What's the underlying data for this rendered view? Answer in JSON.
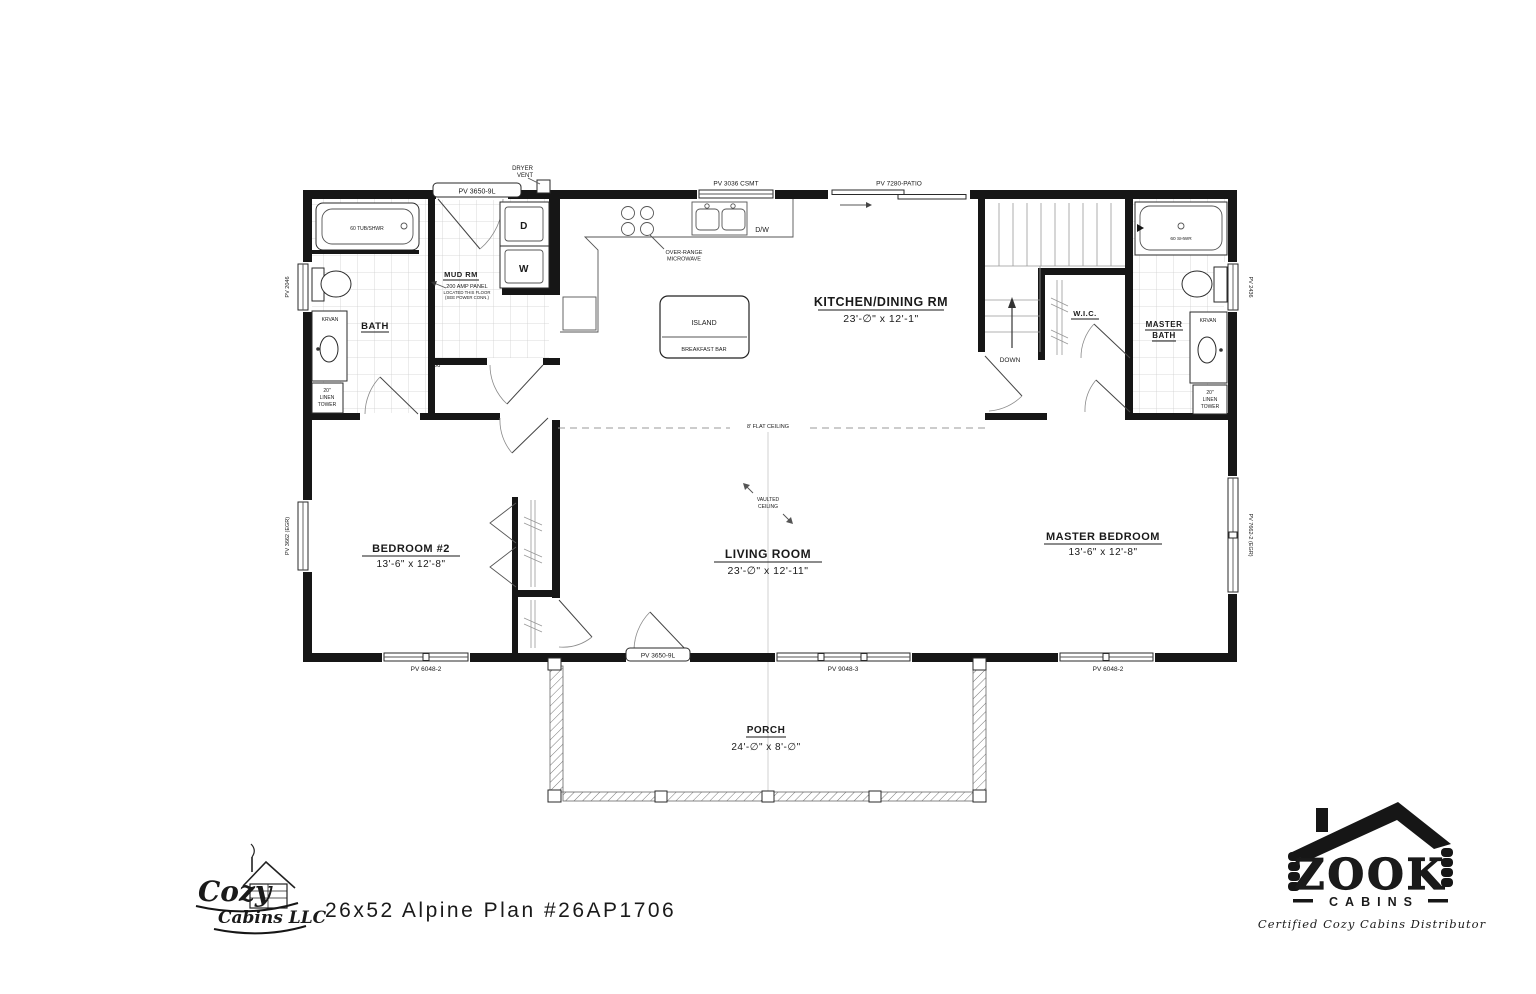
{
  "title": "26x52 Alpine  Plan #26AP1706",
  "rooms": {
    "bath": {
      "name": "BATH"
    },
    "mud_rm": {
      "name": "MUD RM",
      "panel": "200 AMP PANEL",
      "panel_note1": "LOCATED THIS FLOOR",
      "panel_note2": "(SEE POWER CONN.)"
    },
    "kitchen_dining": {
      "name": "KITCHEN/DINING RM",
      "dims": "23'-∅\" x 12'-1\""
    },
    "wic": {
      "name": "W.I.C."
    },
    "master_bath": {
      "name_line1": "MASTER",
      "name_line2": "BATH"
    },
    "bedroom2": {
      "name": "BEDROOM #2",
      "dims": "13'-6\" x 12'-8\""
    },
    "living_room": {
      "name": "LIVING ROOM",
      "dims": "23'-∅\" x 12'-11\""
    },
    "master_bedroom": {
      "name": "MASTER BEDROOM",
      "dims": "13'-6\" x 12'-8\""
    },
    "porch": {
      "name": "PORCH",
      "dims": "24'-∅\" x 8'-∅\""
    },
    "stairs": {
      "down": "DOWN"
    }
  },
  "fixtures": {
    "tub": "60 TUB/SHWR",
    "shower": "60 SHWR",
    "island": "ISLAND",
    "breakfast_bar": "BREAKFAST BAR",
    "dryer": "D",
    "washer": "W",
    "dishwasher": "D/W",
    "microwave_line1": "OVER-RANGE",
    "microwave_line2": "MICROWAVE",
    "dryer_vent_line1": "DRYER",
    "dryer_vent_line2": "VENT",
    "vanity": "KRVAN",
    "linen_line1": "20\"",
    "linen_line2": "LINEN",
    "linen_line3": "TOWER",
    "door_width": "36"
  },
  "ceiling": {
    "flat": "8' FLAT CEILING",
    "vaulted_line1": "VAULTED",
    "vaulted_line2": "CEILING"
  },
  "openings": {
    "door_9l": "PV 3650-9L",
    "kitchen_window": "PV 3036 CSMT",
    "patio_door": "PV 7280-PATIO",
    "bath_window": "PV 2046",
    "bedroom2_side_window": "PV 3662 (EGR)",
    "master_bath_window": "PV 2436",
    "master_side_window": "PV 7662-2 (EGR)",
    "window_6048": "PV 6048-2",
    "living_window": "PV 9048-3"
  },
  "branding": {
    "cozy_line1": "Cozy",
    "cozy_line2": "Cabins LLC",
    "zook": "ZOOK",
    "zook_sub": "CABINS",
    "zook_tagline": "Certified Cozy Cabins Distributor",
    "zook_red": "#9e2433",
    "ink": "#161616"
  }
}
